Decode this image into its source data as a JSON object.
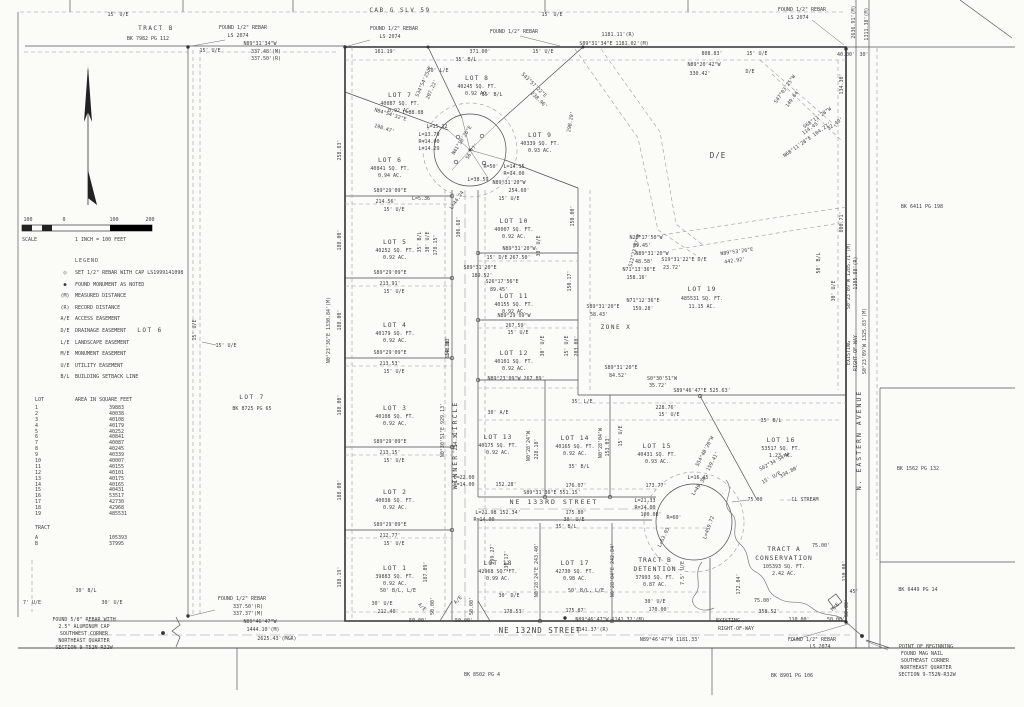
{
  "title_block": {
    "sheet_name": "Plat of Survey"
  },
  "legend": {
    "title": "LEGEND",
    "items": [
      {
        "sym": "◎",
        "label": "SET 1/2\" REBAR WITH CAP LS1999141098"
      },
      {
        "sym": "●",
        "label": "FOUND MONUMENT AS NOTED"
      },
      {
        "sym": "(M)",
        "label": "MEASURED DISTANCE"
      },
      {
        "sym": "(R)",
        "label": "RECORD DISTANCE"
      },
      {
        "sym": "A/E",
        "label": "ACCESS EASEMENT"
      },
      {
        "sym": "D/E",
        "label": "DRAINAGE EASEMENT"
      },
      {
        "sym": "L/E",
        "label": "LANDSCAPE EASEMENT"
      },
      {
        "sym": "M/E",
        "label": "MONUMENT EASEMENT"
      },
      {
        "sym": "U/E",
        "label": "UTILITY EASEMENT"
      },
      {
        "sym": "B/L",
        "label": "BUILDING SETBACK LINE"
      }
    ]
  },
  "scale": {
    "ticks": [
      "100",
      "0",
      "100",
      "200"
    ],
    "label": "SCALE",
    "equiv": "1 INCH  =  100 FEET"
  },
  "area_table": {
    "h1": "LOT",
    "h2": "AREA IN SQUARE FEET",
    "rows": [
      [
        "1",
        "39883"
      ],
      [
        "2",
        "40038"
      ],
      [
        "3",
        "40108"
      ],
      [
        "4",
        "40179"
      ],
      [
        "5",
        "40252"
      ],
      [
        "6",
        "40841"
      ],
      [
        "7",
        "40087"
      ],
      [
        "8",
        "40245"
      ],
      [
        "9",
        "40339"
      ],
      [
        "10",
        "40007"
      ],
      [
        "11",
        "40155"
      ],
      [
        "12",
        "40101"
      ],
      [
        "13",
        "40175"
      ],
      [
        "14",
        "40165"
      ],
      [
        "15",
        "40431"
      ],
      [
        "16",
        "53517"
      ],
      [
        "17",
        "42730"
      ],
      [
        "18",
        "42968"
      ],
      [
        "19",
        "485531"
      ]
    ],
    "tract_header": "TRACT",
    "tract_rows": [
      [
        "A",
        "105393"
      ],
      [
        "B",
        "37995"
      ]
    ]
  },
  "lots": {
    "l1": {
      "n": "LOT 1",
      "sf": "39883 SQ. FT.",
      "ac": "0.92 AC."
    },
    "l2": {
      "n": "LOT 2",
      "sf": "40038 SQ. FT.",
      "ac": "0.92 AC."
    },
    "l3": {
      "n": "LOT 3",
      "sf": "40108 SQ. FT.",
      "ac": "0.92 AC."
    },
    "l4": {
      "n": "LOT 4",
      "sf": "40179 SQ. FT.",
      "ac": "0.92 AC."
    },
    "l5": {
      "n": "LOT 5",
      "sf": "40252 SQ. FT.",
      "ac": "0.92 AC."
    },
    "l6": {
      "n": "LOT 6",
      "sf": "40841 SQ. FT.",
      "ac": "0.94 AC."
    },
    "l7": {
      "n": "LOT 7",
      "sf": "40087 SQ. FT.",
      "ac": "0.92 AC."
    },
    "l8": {
      "n": "LOT 8",
      "sf": "40245 SQ. FT.",
      "ac": "0.92 AC."
    },
    "l9": {
      "n": "LOT 9",
      "sf": "40339 SQ. FT.",
      "ac": "0.93 AC."
    },
    "l10": {
      "n": "LOT 10",
      "sf": "40007 SQ. FT.",
      "ac": "0.92 AC."
    },
    "l11": {
      "n": "LOT 11",
      "sf": "40155 SQ. FT.",
      "ac": "0.92 AC."
    },
    "l12": {
      "n": "LOT 12",
      "sf": "40101 SQ. FT.",
      "ac": "0.92 AC."
    },
    "l13": {
      "n": "LOT 13",
      "sf": "40175 SQ. FT.",
      "ac": "0.92 AC."
    },
    "l14": {
      "n": "LOT 14",
      "sf": "40165 SQ. FT.",
      "ac": "0.92 AC."
    },
    "l15": {
      "n": "LOT 15",
      "sf": "40431 SQ. FT.",
      "ac": "0.93 AC."
    },
    "l16": {
      "n": "LOT 16",
      "sf": "53517 SQ. FT.",
      "ac": "1.23 AC."
    },
    "l17": {
      "n": "LOT 17",
      "sf": "42730 SQ. FT.",
      "ac": "0.98 AC."
    },
    "l18": {
      "n": "LOT 18",
      "sf": "42968 SQ. FT.",
      "ac": "0.99 AC."
    },
    "l19": {
      "n": "LOT 19",
      "sf": "485531 SQ. FT.",
      "ac": "11.15 AC."
    },
    "tract_a": {
      "l1": "TRACT A",
      "l2": "CONSERVATION",
      "l3": "105393 SQ. FT.",
      "l4": "2.42 AC."
    },
    "tract_b": {
      "l1": "TRACT B",
      "l2": "DETENTION",
      "l3": "37993 SQ. FT.",
      "l4": "0.87 AC."
    }
  },
  "labels": {
    "top": [
      "15' U/E",
      "TRACT B",
      "BK 7982 PG 112",
      "FOUND 1/2\" REBAR",
      "LS 2074",
      "N89°31'34\"W",
      "337.48'(M)",
      "337.50'(R)",
      "15' U/E",
      "FOUND 1/2\" REBAR",
      "LS 2074",
      "FOUND 1/2\" REBAR",
      "1181.11'(R)",
      "S89°31'34\"E  1181.02'(M)",
      "161.19'",
      "371.00'",
      "15' U/E",
      "CAB G SLV 59",
      "15' U/E",
      "FOUND 1/2\" REBAR",
      "LS 2074",
      "808.83'",
      "15' U/E",
      "40.00'",
      "30'",
      "N89°20'42\"W",
      "330.42'",
      "D/E",
      "2636.91'(M)",
      "1311.38'(M)",
      "D/E",
      "35' B/L",
      "50' L/E",
      "35' B/L"
    ],
    "west": [
      "LOT 6",
      "LOT 7",
      "BK 8725 PG 65",
      "15' U/E",
      "N0°23'36\"E  1330.84'(M)",
      "188.00'",
      "188.00'",
      "188.00'",
      "188.00'",
      "188.19'",
      "258.83'",
      "7' U/E",
      "30' U/E",
      "30' B/L",
      "FOUND 1/2\" REBAR",
      "337.50'(R)",
      "337.37'(M)",
      "N89°46'47\"W",
      "1444.10'(M)",
      "2625.43'(M&R)",
      "FOUND 5/8\" REBAR WITH",
      "2.5\" ALUMINUM CAP",
      "SOUTHWEST CORNER",
      "NORTHEAST QUARTER",
      "SECTION 9-T52N-R32W",
      "15' U/E"
    ],
    "col": [
      "S89°29'09\"E",
      "214.56'",
      "L=5.36",
      "15' U/E",
      "S89°29'09\"E",
      "213.91'",
      "15' U/E",
      "S89°29'09\"E",
      "213.53'",
      "15' U/E",
      "S89°29'09\"E",
      "213.15'",
      "15' U/E",
      "S89°29'09\"E",
      "212.77'",
      "15' U/E",
      "50' B/L, L/E",
      "30' U/E",
      "212.40'",
      "35' B/L",
      "30' U/E",
      "178.15'",
      "187.09'",
      "A/E",
      "A/E",
      "50.00'",
      "50.00'",
      "50.00'",
      "50.00'",
      "299.27'",
      "230.17'"
    ],
    "street": [
      "WINNER'S CIRCLE",
      "N0°30'51\"E  929.13'",
      "659.80'",
      "NE 133RD STREET",
      "S89°31'36\"E   551.15'",
      "L=22.00",
      "R=14.00",
      "152.28'",
      "176.07'",
      "173.77'",
      "L=16.45",
      "L=21.98  152.34'",
      "R=14.00",
      "175.80'",
      "30' U/E",
      "35' B/L",
      "L=21.33",
      "R=14.00",
      "100.08'",
      "R=60'",
      "NE 132ND STREET",
      "N89°46'47\"W   1141.32'(M)",
      "1141.37'(R)",
      "N89°46'47\"W   1181.33'",
      "178.53'",
      "175.87'",
      "170.00'",
      "30' U/E",
      "EXISTING",
      "RIGHT-OF-WAY"
    ],
    "mid": [
      "L=44.24",
      "L=38.59",
      "N89°31'20\"W",
      "254.60'",
      "15' U/E",
      "N89°31'20\"W",
      "15' D/E",
      "267.50'",
      "S89°31'20\"E",
      "189.52'",
      "S26°17'56\"E",
      "89.45'",
      "N89°29'09\"W",
      "267.59'",
      "15' U/E",
      "N89°23'09\"W",
      "267.89'",
      "150.00'",
      "150.17'",
      "148.83'",
      "106.68'",
      "30' U/E",
      "30' U/E",
      "203.08'",
      "15' U/E",
      "ZONE X",
      "N26°17'50\"W",
      "89.45'",
      "N89°31'20\"W",
      "48.58'",
      "N71°13'36\"E",
      "158.16'",
      "N71°12'36\"E",
      "159.28'",
      "S89°31'20\"E",
      "58.43'",
      "S89°31'20\"E",
      "84.52'",
      "S0°30'51\"W",
      "35.72'",
      "S19°31'22\"E  D/E",
      "23.72'",
      "N89°53'26\"E",
      "442.92'",
      "S12°23'57\"W"
    ],
    "east": [
      "50' B/L",
      "30' U/E",
      "S0°23'09\"W  1285.71'(M)",
      "1285.88'(R)",
      "EXISTING",
      "RIGHT-OF-WAY",
      "S0°23'09\"W  1325.83'(M)",
      "N. EASTERN AVENUE",
      "800.71'",
      "BK 6411 PG 198",
      "BK 1562 PG 132",
      "BK 6449 PG 14",
      "134.30'",
      "S68°11'28\"W",
      "114.45'",
      "N68°11'28\"E  104.27'",
      "S47°03'25\"W",
      "149.64'",
      "32.40'",
      "S89°46'47\"E   525.63'",
      "228.76'",
      "15' U/E",
      "35' B/L",
      "S54°40'20\"W",
      "159.41'",
      "S62°34'54\"W",
      "334.80'",
      "15' U/E"
    ],
    "row": [
      "35' L/E",
      "35' B/L",
      "30' A/E",
      "214.31'",
      "N0°28'24\"W",
      "228.18'",
      "N0°28'04\"W",
      "153.03'",
      "15' U/E"
    ],
    "bulb": [
      "L=88.08",
      "L=15.32",
      "L=13.79",
      "R=14.00",
      "L=14.29",
      "N41°18'26\"E",
      "56.77'",
      "R=50'",
      "L=14.15",
      "R=14.00",
      "N84°54'32\"E",
      "198.47'",
      "S34°54'25\"E",
      "207.22'",
      "S43°57'22\"E",
      "238.96'",
      "298.29'",
      "L=63.03",
      "L=459.72",
      "L=49.38",
      "172.04'",
      "7.5' U/E"
    ],
    "south": [
      "N0°28'24\"E  243.40'",
      "N0°28'04\"E  242.84'",
      "30' D/E",
      "50' B/L, L/E"
    ],
    "tract": [
      "CL STREAM",
      "75.00",
      "75.00'",
      "75.00'",
      "358.52'",
      "110.00'",
      "50.00'",
      "110.00'",
      "45'",
      "50.00'",
      "M/E",
      "FOUND 1/2\" REBAR",
      "LS 2074",
      "POINT OF BEGINNING",
      "FOUND MAG NAIL",
      "SOUTHEAST CORNER",
      "NORTHEAST QUARTER",
      "SECTION 9-T52N-R32W",
      "BK 8502 PG 4",
      "BK 8901 PG 106"
    ]
  }
}
